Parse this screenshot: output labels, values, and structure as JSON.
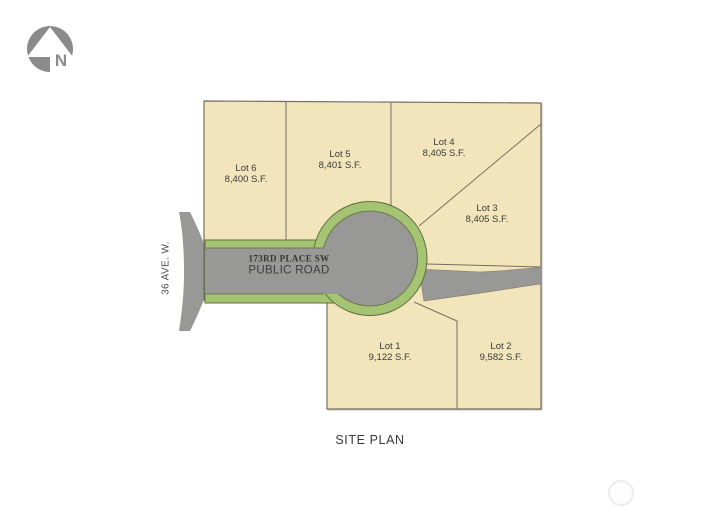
{
  "north_arrow": {
    "label": "N"
  },
  "streets": {
    "left_street": "36 AVE. W.",
    "road_name": "173RD PLACE SW",
    "road_type": "PUBLIC ROAD"
  },
  "title": "SITE PLAN",
  "lots": [
    {
      "name": "Lot 1",
      "area": "9,122 S.F.",
      "x": 390,
      "y": 352
    },
    {
      "name": "Lot 2",
      "area": "9,582 S.F.",
      "x": 501,
      "y": 352
    },
    {
      "name": "Lot 3",
      "area": "8,405 S.F.",
      "x": 487,
      "y": 214
    },
    {
      "name": "Lot 4",
      "area": "8,405 S.F.",
      "x": 444,
      "y": 148
    },
    {
      "name": "Lot 5",
      "area": "8,401 S.F.",
      "x": 340,
      "y": 160
    },
    {
      "name": "Lot 6",
      "area": "8,400 S.F.",
      "x": 246,
      "y": 174
    }
  ],
  "colors": {
    "lot_fill": "#f2e5bc",
    "lot_line": "#776f5d",
    "road_gray": "#989896",
    "planting_green": "#a5c473",
    "green_edge": "#5f6e3c",
    "arrow_gray": "#8b8b8b",
    "text": "#3a3a3a"
  }
}
